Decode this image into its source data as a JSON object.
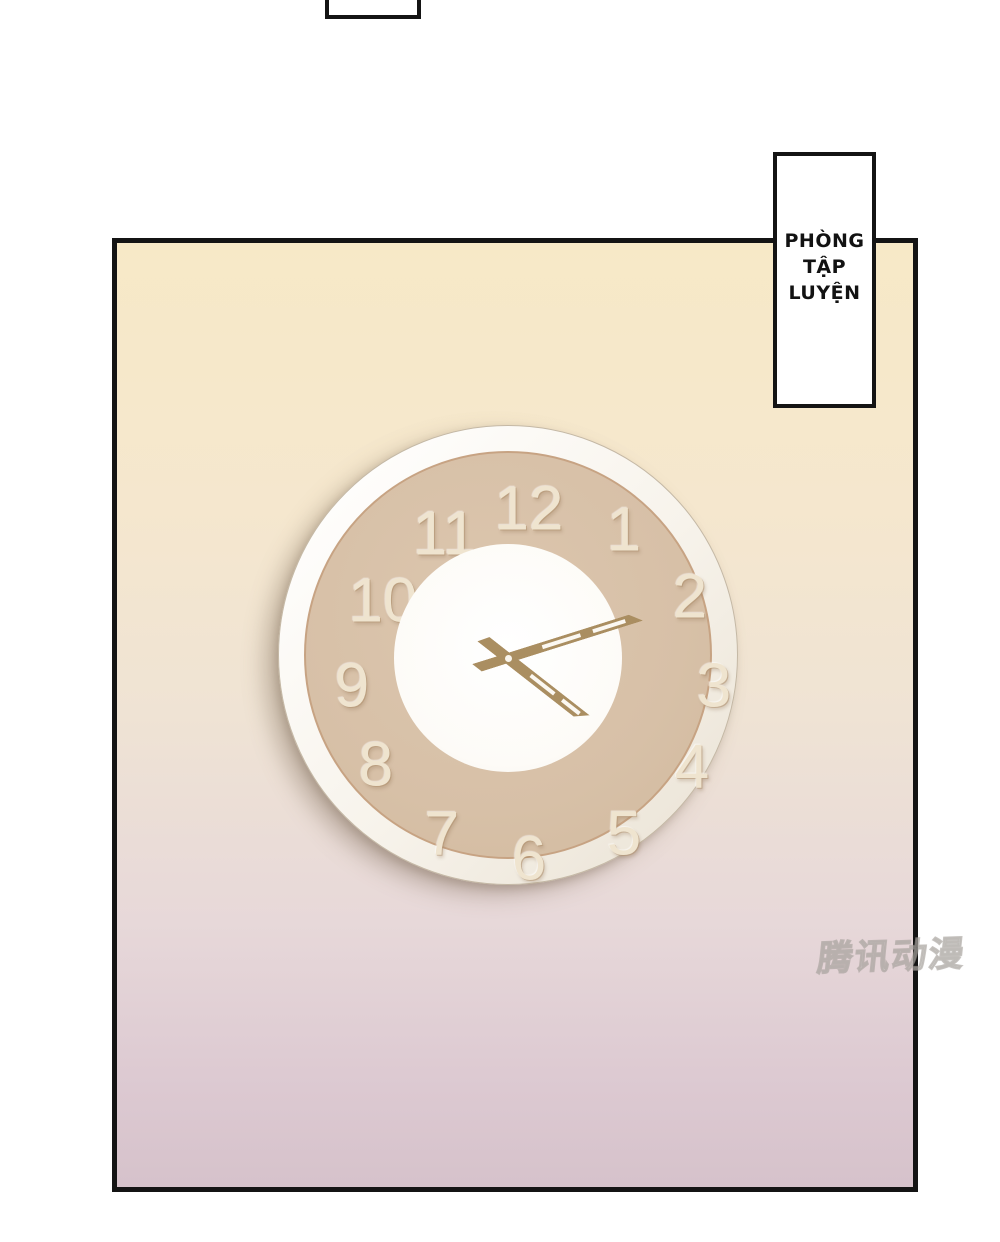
{
  "scene": {
    "type": "comic-panel",
    "background_color": "#ffffff"
  },
  "panel": {
    "border_color": "#141414",
    "gradient_top_color": "#f7e9c7",
    "gradient_bottom_color": "#d6c2cb"
  },
  "caption_box": {
    "lines": [
      "PHÒNG",
      "TẬP",
      "LUYỆN"
    ],
    "text_color": "#121212",
    "background_color": "#ffffff",
    "border_color": "#141414"
  },
  "clock": {
    "numerals": [
      "12",
      "1",
      "2",
      "3",
      "4",
      "5",
      "6",
      "7",
      "8",
      "9",
      "10",
      "11"
    ],
    "time_shown": "4:12",
    "minute_hand_angle_deg": 72.5,
    "hour_hand_angle_deg": 128,
    "ring_color": "#f8f4ec",
    "face_color": "#d7c0a7",
    "center_disc_color": "#fdfbf7",
    "hand_color": "#aa8e61",
    "numeral_color": "#efe4cf"
  },
  "watermark": {
    "text": "腾讯动漫"
  }
}
